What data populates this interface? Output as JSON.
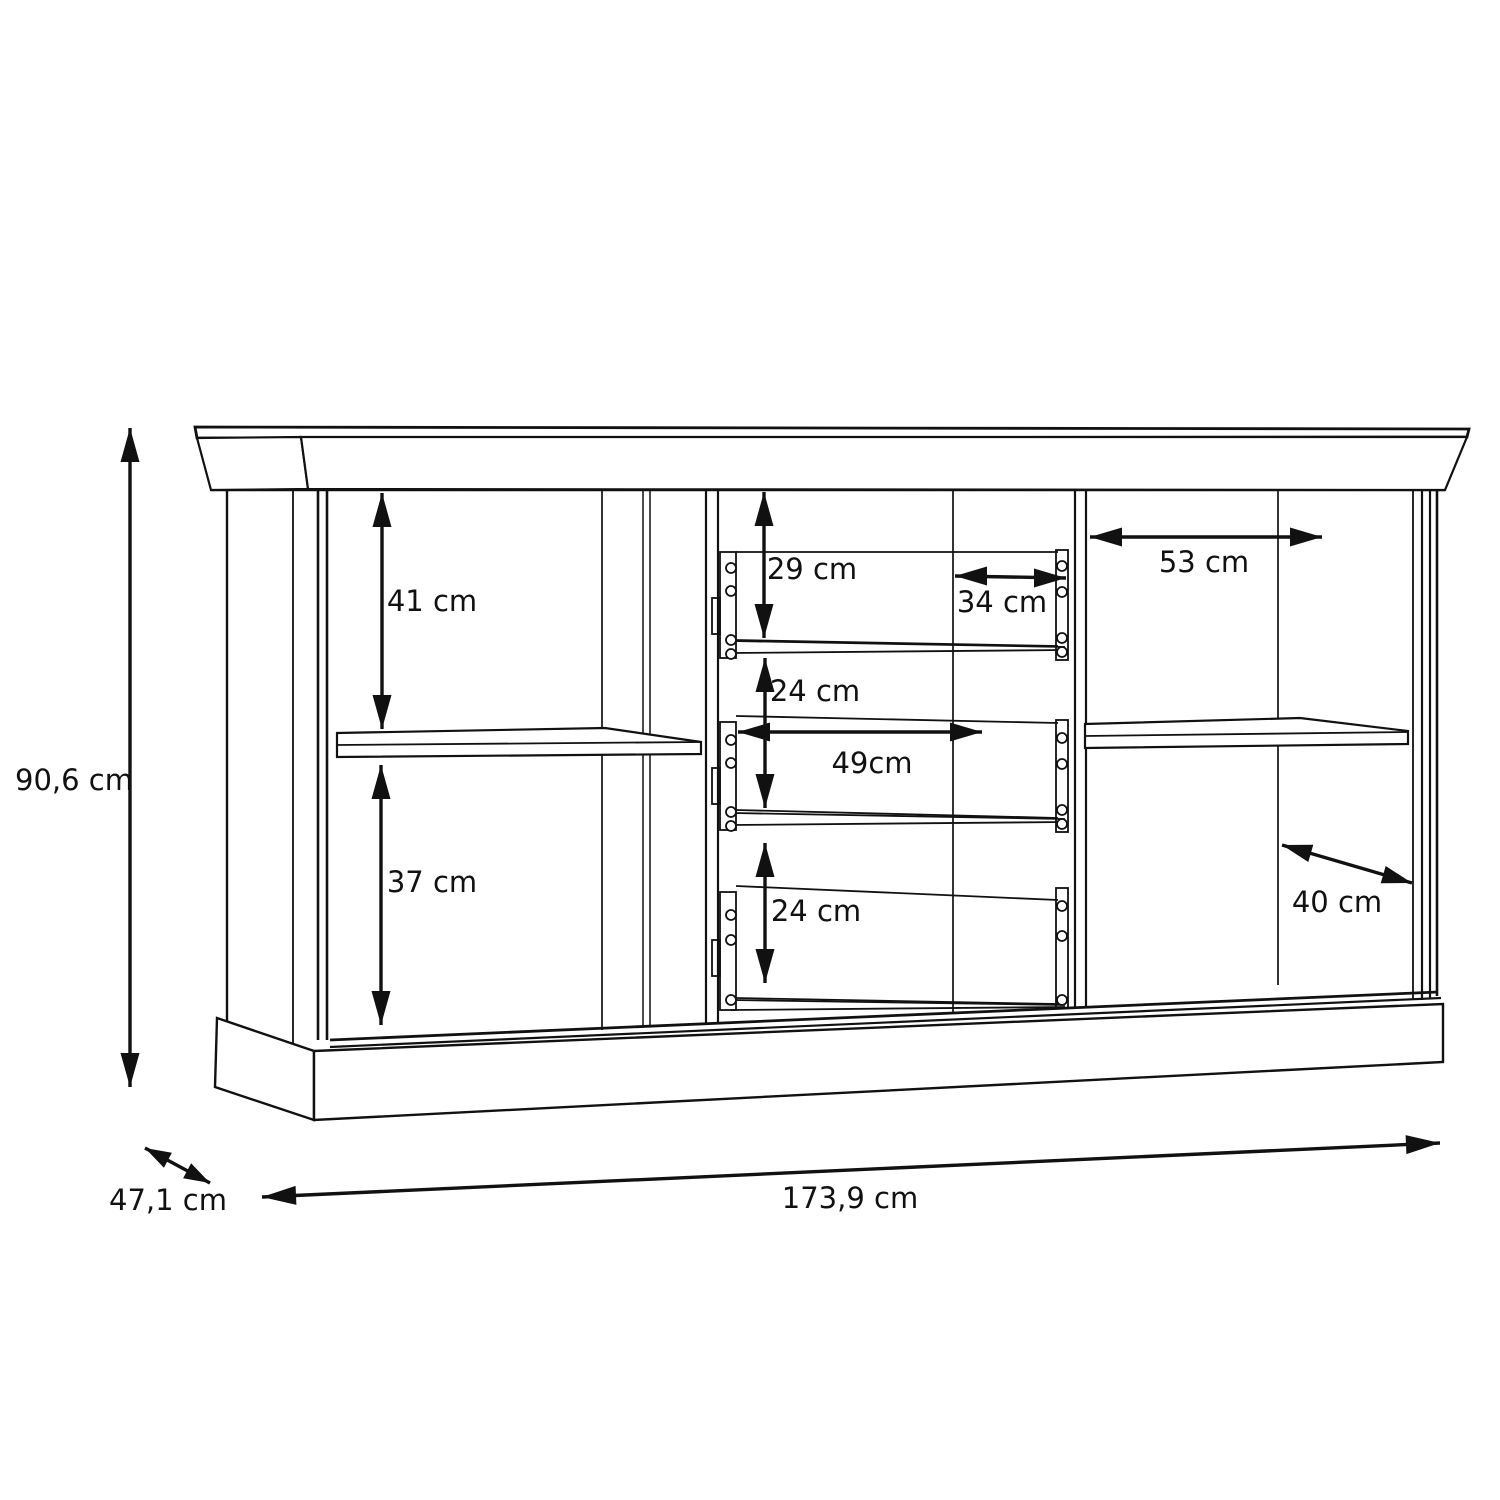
{
  "diagram": {
    "kind": "sideboard-dimension-drawing",
    "background": "#ffffff",
    "line_color": "#111111"
  },
  "dimensions": {
    "overall_height": "90,6 cm",
    "overall_width": "173,9 cm",
    "overall_depth": "47,1 cm",
    "left_upper_compartment_height": "41 cm",
    "left_lower_compartment_height": "37 cm",
    "top_drawer_height": "29 cm",
    "middle_drawer_height": "24 cm",
    "bottom_drawer_height": "24 cm",
    "drawer_inner_depth": "34 cm",
    "drawer_inner_width": "49cm",
    "right_compartment_width": "53 cm",
    "right_compartment_depth": "40 cm"
  }
}
